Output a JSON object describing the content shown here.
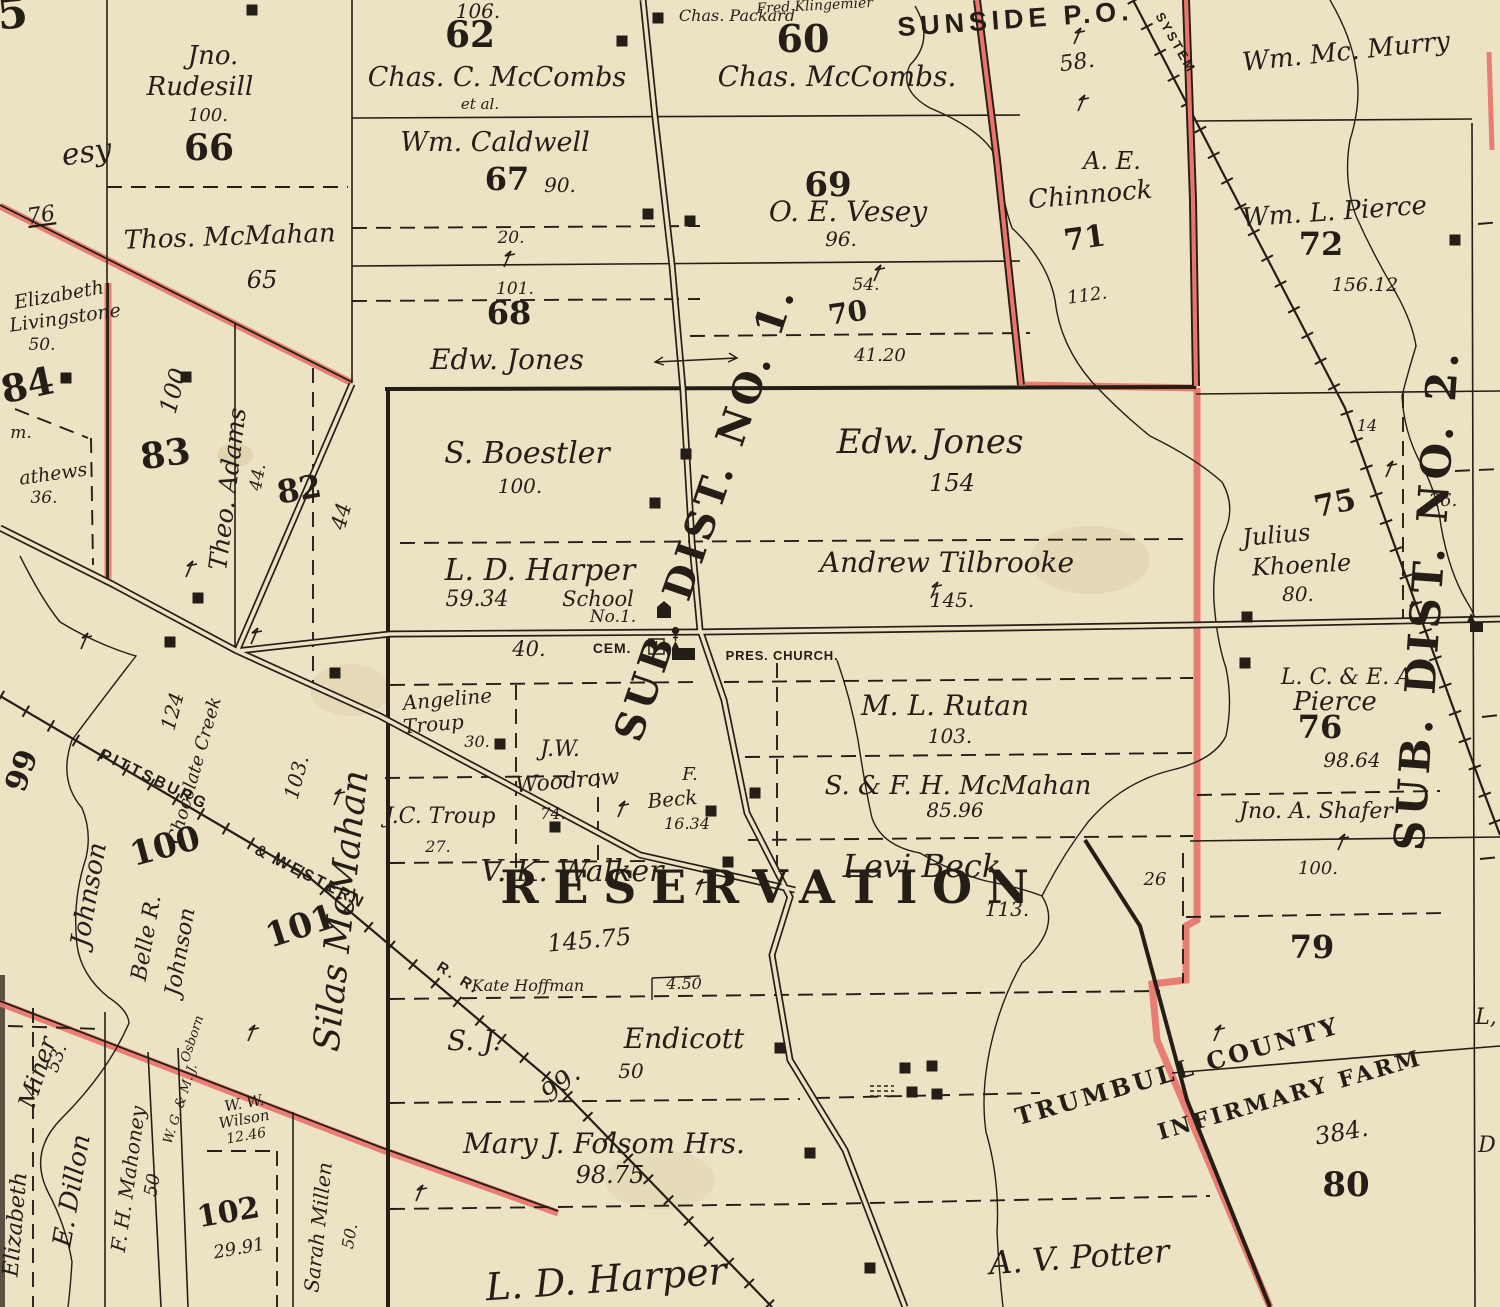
{
  "map": {
    "type": "historic-plat-map",
    "colors": {
      "paper": "#ece3c4",
      "ink": "#241e16",
      "red": "#dd5348",
      "red_light": "#e8746b"
    },
    "icons": [
      "church-icon",
      "cemetery-cross-icon",
      "school-icon",
      "building-marker",
      "survey-mark",
      "railroad-ticks"
    ],
    "labels": [
      {
        "t": "5",
        "x": 14,
        "y": 28,
        "s": 44,
        "st": "num",
        "r": -6
      },
      {
        "t": "esy",
        "x": 88,
        "y": 162,
        "s": 30,
        "st": "script",
        "r": -8
      },
      {
        "t": "76",
        "x": 42,
        "y": 222,
        "s": 22,
        "st": "script",
        "r": -8,
        "u": true
      },
      {
        "t": "Jno.",
        "x": 213,
        "y": 64,
        "s": 26,
        "st": "script"
      },
      {
        "t": "Rudesill",
        "x": 200,
        "y": 95,
        "s": 26,
        "st": "script"
      },
      {
        "t": "100.",
        "x": 208,
        "y": 121,
        "s": 18,
        "st": "script"
      },
      {
        "t": "66",
        "x": 209,
        "y": 160,
        "s": 36,
        "st": "num"
      },
      {
        "t": "Thos. McMahan",
        "x": 230,
        "y": 245,
        "s": 26,
        "st": "script",
        "r": -2
      },
      {
        "t": "65",
        "x": 262,
        "y": 288,
        "s": 24,
        "st": "script"
      },
      {
        "t": "Elizabeth",
        "x": 60,
        "y": 301,
        "s": 19,
        "st": "script",
        "r": -10
      },
      {
        "t": "Livingstone",
        "x": 66,
        "y": 324,
        "s": 19,
        "st": "script",
        "r": -8
      },
      {
        "t": "50.",
        "x": 42,
        "y": 350,
        "s": 17,
        "st": "script"
      },
      {
        "t": "84",
        "x": 30,
        "y": 398,
        "s": 38,
        "st": "num",
        "r": -12
      },
      {
        "t": "m.",
        "x": 21,
        "y": 438,
        "s": 17,
        "st": "script"
      },
      {
        "t": "athews",
        "x": 54,
        "y": 480,
        "s": 19,
        "st": "script",
        "r": -8
      },
      {
        "t": "36.",
        "x": 44,
        "y": 503,
        "s": 17,
        "st": "script"
      },
      {
        "t": "83",
        "x": 167,
        "y": 466,
        "s": 36,
        "st": "num",
        "r": -8
      },
      {
        "t": "100",
        "x": 181,
        "y": 393,
        "s": 24,
        "st": "script",
        "r": -75
      },
      {
        "t": "Theo. Adams",
        "x": 236,
        "y": 490,
        "s": 25,
        "st": "script",
        "r": -83
      },
      {
        "t": "44.",
        "x": 263,
        "y": 478,
        "s": 17,
        "st": "script",
        "r": -80
      },
      {
        "t": "82",
        "x": 301,
        "y": 500,
        "s": 32,
        "st": "num",
        "r": -10
      },
      {
        "t": "44",
        "x": 348,
        "y": 518,
        "s": 21,
        "st": "script",
        "r": -75
      },
      {
        "t": "106.",
        "x": 478,
        "y": 18,
        "s": 20,
        "st": "script"
      },
      {
        "t": "62",
        "x": 470,
        "y": 47,
        "s": 36,
        "st": "num"
      },
      {
        "t": "Chas. C. McCombs",
        "x": 497,
        "y": 86,
        "s": 27,
        "st": "script"
      },
      {
        "t": "et al.",
        "x": 480,
        "y": 109,
        "s": 15,
        "st": "script"
      },
      {
        "t": "Wm. Caldwell",
        "x": 495,
        "y": 151,
        "s": 27,
        "st": "script"
      },
      {
        "t": "67",
        "x": 507,
        "y": 190,
        "s": 32,
        "st": "num"
      },
      {
        "t": "90.",
        "x": 560,
        "y": 192,
        "s": 20,
        "st": "script"
      },
      {
        "t": "20.",
        "x": 511,
        "y": 243,
        "s": 17,
        "st": "script"
      },
      {
        "t": "101.",
        "x": 515,
        "y": 294,
        "s": 17,
        "st": "script"
      },
      {
        "t": "68",
        "x": 509,
        "y": 324,
        "s": 32,
        "st": "num"
      },
      {
        "t": "Edw. Jones",
        "x": 507,
        "y": 369,
        "s": 28,
        "st": "script"
      },
      {
        "t": "Fred Klingemier",
        "x": 815,
        "y": 10,
        "s": 14,
        "st": "script",
        "r": -3
      },
      {
        "t": "Chas. Packard",
        "x": 737,
        "y": 21,
        "s": 16,
        "st": "script"
      },
      {
        "t": "60",
        "x": 803,
        "y": 52,
        "s": 38,
        "st": "num"
      },
      {
        "t": "Chas. McCombs.",
        "x": 837,
        "y": 86,
        "s": 28,
        "st": "script"
      },
      {
        "t": "69",
        "x": 828,
        "y": 196,
        "s": 34,
        "st": "num"
      },
      {
        "t": "O. E. Vesey",
        "x": 848,
        "y": 221,
        "s": 28,
        "st": "script"
      },
      {
        "t": "96.",
        "x": 841,
        "y": 246,
        "s": 20,
        "st": "script"
      },
      {
        "t": "54.",
        "x": 866,
        "y": 290,
        "s": 17,
        "st": "script"
      },
      {
        "t": "70",
        "x": 849,
        "y": 322,
        "s": 28,
        "st": "num",
        "r": -8
      },
      {
        "t": "41.20",
        "x": 880,
        "y": 361,
        "s": 18,
        "st": "script"
      },
      {
        "t": "SUNSIDE P.O.",
        "x": 1016,
        "y": 28,
        "s": 27,
        "st": "caps",
        "r": -4
      },
      {
        "t": "58.",
        "x": 1078,
        "y": 69,
        "s": 22,
        "st": "script",
        "r": -8
      },
      {
        "t": "Wm. Mc. Murry",
        "x": 1347,
        "y": 60,
        "s": 26,
        "st": "script",
        "r": -6
      },
      {
        "t": "A. E.",
        "x": 1112,
        "y": 169,
        "s": 24,
        "st": "script"
      },
      {
        "t": "Chinnock",
        "x": 1091,
        "y": 203,
        "s": 26,
        "st": "script",
        "r": -5
      },
      {
        "t": "71",
        "x": 1086,
        "y": 248,
        "s": 30,
        "st": "num",
        "r": -8
      },
      {
        "t": "112.",
        "x": 1088,
        "y": 301,
        "s": 18,
        "st": "script",
        "r": -8
      },
      {
        "t": "Wm. L. Pierce",
        "x": 1335,
        "y": 220,
        "s": 26,
        "st": "script",
        "r": -4
      },
      {
        "t": "72",
        "x": 1321,
        "y": 255,
        "s": 32,
        "st": "num"
      },
      {
        "t": "156.12",
        "x": 1365,
        "y": 291,
        "s": 19,
        "st": "script"
      },
      {
        "t": "SYSTEM",
        "x": 1172,
        "y": 45,
        "s": 13,
        "st": "caps",
        "r": 60
      },
      {
        "t": "14",
        "x": 1367,
        "y": 431,
        "s": 16,
        "st": "script"
      },
      {
        "t": "26.",
        "x": 1443,
        "y": 506,
        "s": 18,
        "st": "script"
      },
      {
        "t": "S. Boestler",
        "x": 527,
        "y": 463,
        "s": 30,
        "st": "script"
      },
      {
        "t": "100.",
        "x": 520,
        "y": 493,
        "s": 20,
        "st": "script"
      },
      {
        "t": "Edw. Jones",
        "x": 930,
        "y": 453,
        "s": 34,
        "st": "script"
      },
      {
        "t": "154",
        "x": 952,
        "y": 491,
        "s": 24,
        "st": "script"
      },
      {
        "t": "L. D. Harper",
        "x": 540,
        "y": 580,
        "s": 30,
        "st": "script"
      },
      {
        "t": "59.34",
        "x": 477,
        "y": 606,
        "s": 22,
        "st": "script"
      },
      {
        "t": "School",
        "x": 598,
        "y": 606,
        "s": 21,
        "st": "script"
      },
      {
        "t": "No.1.",
        "x": 613,
        "y": 622,
        "s": 17,
        "st": "script"
      },
      {
        "t": "40.",
        "x": 529,
        "y": 656,
        "s": 21,
        "st": "script"
      },
      {
        "t": "CEM.",
        "x": 612,
        "y": 653,
        "s": 14,
        "st": "smallcaps"
      },
      {
        "t": "PRES. CHURCH.",
        "x": 782,
        "y": 660,
        "s": 13,
        "st": "smallcaps"
      },
      {
        "t": "Andrew Tilbrooke",
        "x": 947,
        "y": 572,
        "s": 28,
        "st": "script"
      },
      {
        "t": "145.",
        "x": 952,
        "y": 607,
        "s": 20,
        "st": "script"
      },
      {
        "t": "Julius",
        "x": 1277,
        "y": 543,
        "s": 24,
        "st": "script",
        "r": -5
      },
      {
        "t": "Khoenle",
        "x": 1302,
        "y": 573,
        "s": 24,
        "st": "script",
        "r": -3
      },
      {
        "t": "80.",
        "x": 1298,
        "y": 601,
        "s": 20,
        "st": "script"
      },
      {
        "t": "75",
        "x": 1337,
        "y": 513,
        "s": 30,
        "st": "num",
        "r": -12
      },
      {
        "t": "99",
        "x": 31,
        "y": 774,
        "s": 30,
        "st": "num",
        "r": -70
      },
      {
        "t": "Johnson",
        "x": 97,
        "y": 896,
        "s": 26,
        "st": "script",
        "r": -80
      },
      {
        "t": "Chocolate Creek",
        "x": 200,
        "y": 772,
        "s": 18,
        "st": "script",
        "r": -74
      },
      {
        "t": "124",
        "x": 179,
        "y": 713,
        "s": 20,
        "st": "script",
        "r": -75
      },
      {
        "t": "100",
        "x": 168,
        "y": 857,
        "s": 34,
        "st": "num",
        "r": -15
      },
      {
        "t": "Belle R.",
        "x": 153,
        "y": 939,
        "s": 22,
        "st": "script",
        "r": -80
      },
      {
        "t": "Johnson",
        "x": 187,
        "y": 953,
        "s": 22,
        "st": "script",
        "r": -80
      },
      {
        "t": "101",
        "x": 304,
        "y": 937,
        "s": 34,
        "st": "num",
        "r": -18
      },
      {
        "t": "103.",
        "x": 303,
        "y": 779,
        "s": 20,
        "st": "script",
        "r": -75
      },
      {
        "t": "Silas McMahan",
        "x": 353,
        "y": 912,
        "s": 36,
        "st": "script",
        "r": -84
      },
      {
        "t": "PITTSBURG",
        "x": 152,
        "y": 784,
        "s": 16,
        "st": "caps",
        "r": 26
      },
      {
        "t": "& WESTERN",
        "x": 308,
        "y": 881,
        "s": 16,
        "st": "caps",
        "r": 27
      },
      {
        "t": "R. R.",
        "x": 456,
        "y": 982,
        "s": 15,
        "st": "caps",
        "r": 32
      },
      {
        "t": "Angeline",
        "x": 448,
        "y": 706,
        "s": 20,
        "st": "script",
        "r": -5
      },
      {
        "t": "Troup",
        "x": 434,
        "y": 731,
        "s": 20,
        "st": "script",
        "r": -5
      },
      {
        "t": "30.",
        "x": 477,
        "y": 747,
        "s": 16,
        "st": "script"
      },
      {
        "t": "J.W.",
        "x": 560,
        "y": 756,
        "s": 22,
        "st": "script"
      },
      {
        "t": "Woodrow",
        "x": 568,
        "y": 788,
        "s": 22,
        "st": "script",
        "r": -5
      },
      {
        "t": "74.",
        "x": 553,
        "y": 819,
        "s": 16,
        "st": "script"
      },
      {
        "t": "J.C. Troup",
        "x": 440,
        "y": 823,
        "s": 22,
        "st": "script"
      },
      {
        "t": "27.",
        "x": 438,
        "y": 852,
        "s": 16,
        "st": "script"
      },
      {
        "t": "F.",
        "x": 690,
        "y": 780,
        "s": 18,
        "st": "script"
      },
      {
        "t": "Beck",
        "x": 673,
        "y": 806,
        "s": 20,
        "st": "script",
        "r": -5
      },
      {
        "t": "16.34",
        "x": 687,
        "y": 829,
        "s": 16,
        "st": "script"
      },
      {
        "t": "V. K. Walker",
        "x": 572,
        "y": 881,
        "s": 30,
        "st": "script"
      },
      {
        "t": "M. L. Rutan",
        "x": 945,
        "y": 715,
        "s": 28,
        "st": "script"
      },
      {
        "t": "103.",
        "x": 950,
        "y": 743,
        "s": 20,
        "st": "script"
      },
      {
        "t": "S. & F. H. McMahan",
        "x": 958,
        "y": 794,
        "s": 26,
        "st": "script"
      },
      {
        "t": "85.96",
        "x": 955,
        "y": 817,
        "s": 20,
        "st": "script"
      },
      {
        "t": "Levi Beck",
        "x": 922,
        "y": 877,
        "s": 32,
        "st": "script"
      },
      {
        "t": "113.",
        "x": 1007,
        "y": 916,
        "s": 20,
        "st": "script"
      },
      {
        "t": "26",
        "x": 1155,
        "y": 885,
        "s": 18,
        "st": "script"
      },
      {
        "t": "L. C. & E. A.",
        "x": 1350,
        "y": 684,
        "s": 22,
        "st": "script"
      },
      {
        "t": "Pierce",
        "x": 1335,
        "y": 710,
        "s": 26,
        "st": "script"
      },
      {
        "t": "76",
        "x": 1320,
        "y": 738,
        "s": 32,
        "st": "num"
      },
      {
        "t": "98.64",
        "x": 1352,
        "y": 767,
        "s": 20,
        "st": "script"
      },
      {
        "t": "Jno. A. Shafer",
        "x": 1316,
        "y": 818,
        "s": 22,
        "st": "script"
      },
      {
        "t": "100.",
        "x": 1318,
        "y": 874,
        "s": 18,
        "st": "script"
      },
      {
        "t": "79",
        "x": 1312,
        "y": 958,
        "s": 32,
        "st": "num"
      },
      {
        "t": "RESERVATION",
        "x": 772,
        "y": 903,
        "s": 46,
        "st": "bigcaps"
      },
      {
        "t": "SUB. DIST. NO. 1.",
        "x": 718,
        "y": 517,
        "s": 40,
        "st": "district",
        "r": -71
      },
      {
        "t": "SUB. DIST. NO. 2.",
        "x": 1441,
        "y": 600,
        "s": 42,
        "st": "district",
        "r": -86
      },
      {
        "t": "145.75",
        "x": 590,
        "y": 948,
        "s": 24,
        "st": "script",
        "r": -5
      },
      {
        "t": "Kate Hoffman",
        "x": 528,
        "y": 991,
        "s": 16,
        "st": "script"
      },
      {
        "t": "4.50",
        "x": 684,
        "y": 989,
        "s": 16,
        "st": "script"
      },
      {
        "t": "S. J.",
        "x": 474,
        "y": 1050,
        "s": 28,
        "st": "script"
      },
      {
        "t": "Endicott",
        "x": 684,
        "y": 1048,
        "s": 28,
        "st": "script"
      },
      {
        "t": "50",
        "x": 631,
        "y": 1078,
        "s": 20,
        "st": "script"
      },
      {
        "t": "99.",
        "x": 566,
        "y": 1090,
        "s": 26,
        "st": "script",
        "r": -40
      },
      {
        "t": "Mary J. Folsom Hrs.",
        "x": 604,
        "y": 1153,
        "s": 28,
        "st": "script"
      },
      {
        "t": "98.75",
        "x": 610,
        "y": 1183,
        "s": 24,
        "st": "script"
      },
      {
        "t": "L. D. Harper",
        "x": 607,
        "y": 1292,
        "s": 38,
        "st": "script",
        "r": -4
      },
      {
        "t": "A. V. Potter",
        "x": 1080,
        "y": 1268,
        "s": 32,
        "st": "script",
        "r": -4
      },
      {
        "t": "Miner",
        "x": 45,
        "y": 1075,
        "s": 24,
        "st": "script",
        "r": -72
      },
      {
        "t": "53.",
        "x": 62,
        "y": 1060,
        "s": 18,
        "st": "script",
        "r": -70
      },
      {
        "t": "Elizabeth",
        "x": 22,
        "y": 1225,
        "s": 22,
        "st": "script",
        "r": -85
      },
      {
        "t": "E. Dillon",
        "x": 80,
        "y": 1192,
        "s": 26,
        "st": "script",
        "r": -80
      },
      {
        "t": "F. H. Mahoney",
        "x": 135,
        "y": 1180,
        "s": 20,
        "st": "script",
        "r": -82
      },
      {
        "t": "50",
        "x": 158,
        "y": 1186,
        "s": 18,
        "st": "script",
        "r": -80
      },
      {
        "t": "W. G. & M. J.",
        "x": 184,
        "y": 1105,
        "s": 13,
        "st": "script",
        "r": -72
      },
      {
        "t": "Osborn",
        "x": 196,
        "y": 1040,
        "s": 13,
        "st": "script",
        "r": -72
      },
      {
        "t": "W. W.",
        "x": 245,
        "y": 1108,
        "s": 15,
        "st": "script",
        "r": -10
      },
      {
        "t": "Wilson",
        "x": 245,
        "y": 1124,
        "s": 15,
        "st": "script",
        "r": -10
      },
      {
        "t": "12.46",
        "x": 247,
        "y": 1140,
        "s": 14,
        "st": "script",
        "r": -10
      },
      {
        "t": "102",
        "x": 230,
        "y": 1222,
        "s": 30,
        "st": "num",
        "r": -10
      },
      {
        "t": "29.91",
        "x": 240,
        "y": 1254,
        "s": 18,
        "st": "script",
        "r": -10
      },
      {
        "t": "Sarah Millen",
        "x": 325,
        "y": 1228,
        "s": 20,
        "st": "script",
        "r": -84
      },
      {
        "t": "50.",
        "x": 355,
        "y": 1237,
        "s": 16,
        "st": "script",
        "r": -80
      },
      {
        "t": "TRUMBULL COUNTY",
        "x": 1180,
        "y": 1079,
        "s": 24,
        "st": "serifcaps",
        "r": -16
      },
      {
        "t": "INFIRMARY FARM",
        "x": 1292,
        "y": 1102,
        "s": 22,
        "st": "serifcaps",
        "r": -16
      },
      {
        "t": "384.",
        "x": 1343,
        "y": 1140,
        "s": 24,
        "st": "script",
        "r": -10
      },
      {
        "t": "80",
        "x": 1346,
        "y": 1196,
        "s": 34,
        "st": "num"
      },
      {
        "t": "L,",
        "x": 1486,
        "y": 1024,
        "s": 22,
        "st": "script"
      },
      {
        "t": "D",
        "x": 1487,
        "y": 1152,
        "s": 22,
        "st": "script"
      }
    ]
  }
}
